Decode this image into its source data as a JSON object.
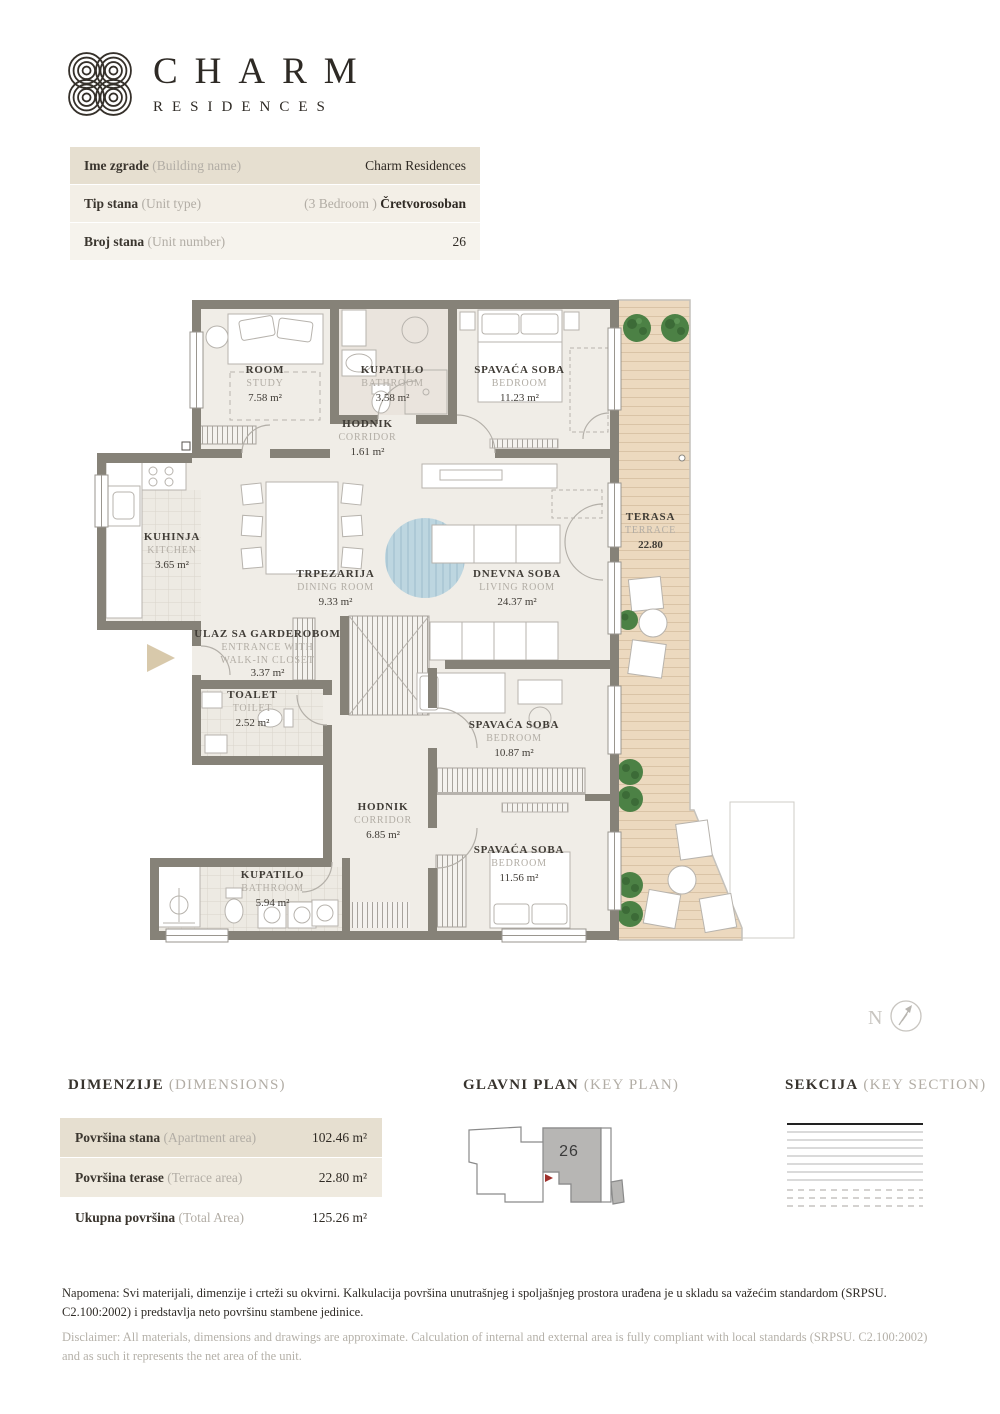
{
  "brand": {
    "name": "CHARM",
    "subtitle": "RESIDENCES"
  },
  "info_table": {
    "rows": [
      {
        "label": "Ime zgrade",
        "label_en": "(Building name)",
        "value_prefix": "",
        "value": "Charm Residences"
      },
      {
        "label": "Tip stana",
        "label_en": "(Unit type)",
        "value_prefix": "(3 Bedroom ) ",
        "value": "Čretvorosoban"
      },
      {
        "label": "Broj stana",
        "label_en": "(Unit number)",
        "value_prefix": "",
        "value": "26"
      }
    ]
  },
  "floor_plan": {
    "compass_label": "N",
    "rooms": [
      {
        "name": "ROOM",
        "name_en": "STUDY",
        "area": "7.58 m²"
      },
      {
        "name": "KUPATILO",
        "name_en": "BATHROOM",
        "area": "3.58 m²"
      },
      {
        "name": "SPAVAĆA SOBA",
        "name_en": "BEDROOM",
        "area": "11.23 m²"
      },
      {
        "name": "HODNIK",
        "name_en": "CORRIDOR",
        "area": "1.61 m²"
      },
      {
        "name": "KUHINJA",
        "name_en": "KITCHEN",
        "area": "3.65 m²"
      },
      {
        "name": "TRPEZARIJA",
        "name_en": "DINING ROOM",
        "area": "9.33 m²"
      },
      {
        "name": "DNEVNA SOBA",
        "name_en": "LIVING ROOM",
        "area": "24.37 m²"
      },
      {
        "name": "ULAZ SA GARDEROBOM",
        "name_en": "ENTRANCE WITH WALK-IN CLOSET",
        "area": "3.37 m²"
      },
      {
        "name": "TOALET",
        "name_en": "TOILET",
        "area": "2.52 m²"
      },
      {
        "name": "HODNIK",
        "name_en": "CORRIDOR",
        "area": "6.85 m²"
      },
      {
        "name": "SPAVAĆA SOBA",
        "name_en": "BEDROOM",
        "area": "10.87 m²"
      },
      {
        "name": "SPAVAĆA SOBA",
        "name_en": "BEDROOM",
        "area": "11.56 m²"
      },
      {
        "name": "KUPATILO",
        "name_en": "BATHROOM",
        "area": "5.94 m²"
      },
      {
        "name": "TERASA",
        "name_en": "TERRACE",
        "area": "22.80"
      }
    ]
  },
  "dimensions": {
    "title": "DIMENZIJE",
    "title_en": "(DIMENSIONS)",
    "rows": [
      {
        "label": "Površina stana",
        "label_en": "(Apartment area)",
        "value": "102.46 m²"
      },
      {
        "label": "Površina terase",
        "label_en": "(Terrace area)",
        "value": "22.80 m²"
      },
      {
        "label": "Ukupna površina",
        "label_en": "(Total Area)",
        "value": "125.26 m²"
      }
    ]
  },
  "key_plan": {
    "title": "GLAVNI PLAN",
    "title_en": "(KEY PLAN)",
    "unit_number": "26"
  },
  "section": {
    "title": "SEKCIJA",
    "title_en": "(KEY SECTION)"
  },
  "notes": {
    "napomena": "Napomena: Svi materijali, dimenzije i crteži su okvirni. Kalkulacija površina unutrašnjeg i spoljašnjeg prostora urađena je u skladu sa važećim standardom (SRPSU. C2.100:2002) i predstavlja neto površinu stambene jedinice.",
    "disclaimer": "Disclaimer: All materials, dimensions and drawings are approximate. Calculation of internal and external area is fully compliant with local standards (SRPSU. C2.100:2002) and as such it represents the net area of the unit."
  },
  "colors": {
    "row_beige": "#e6dfd0",
    "wall": "#868278",
    "floor": "#f0ede7",
    "deck": "#ecd9bf",
    "plant_green": "#4c8145",
    "rug_blue": "#bdd6e0",
    "accent_red": "#a0302c",
    "text_dark": "#3a352e",
    "text_gray": "#b2ada5"
  }
}
